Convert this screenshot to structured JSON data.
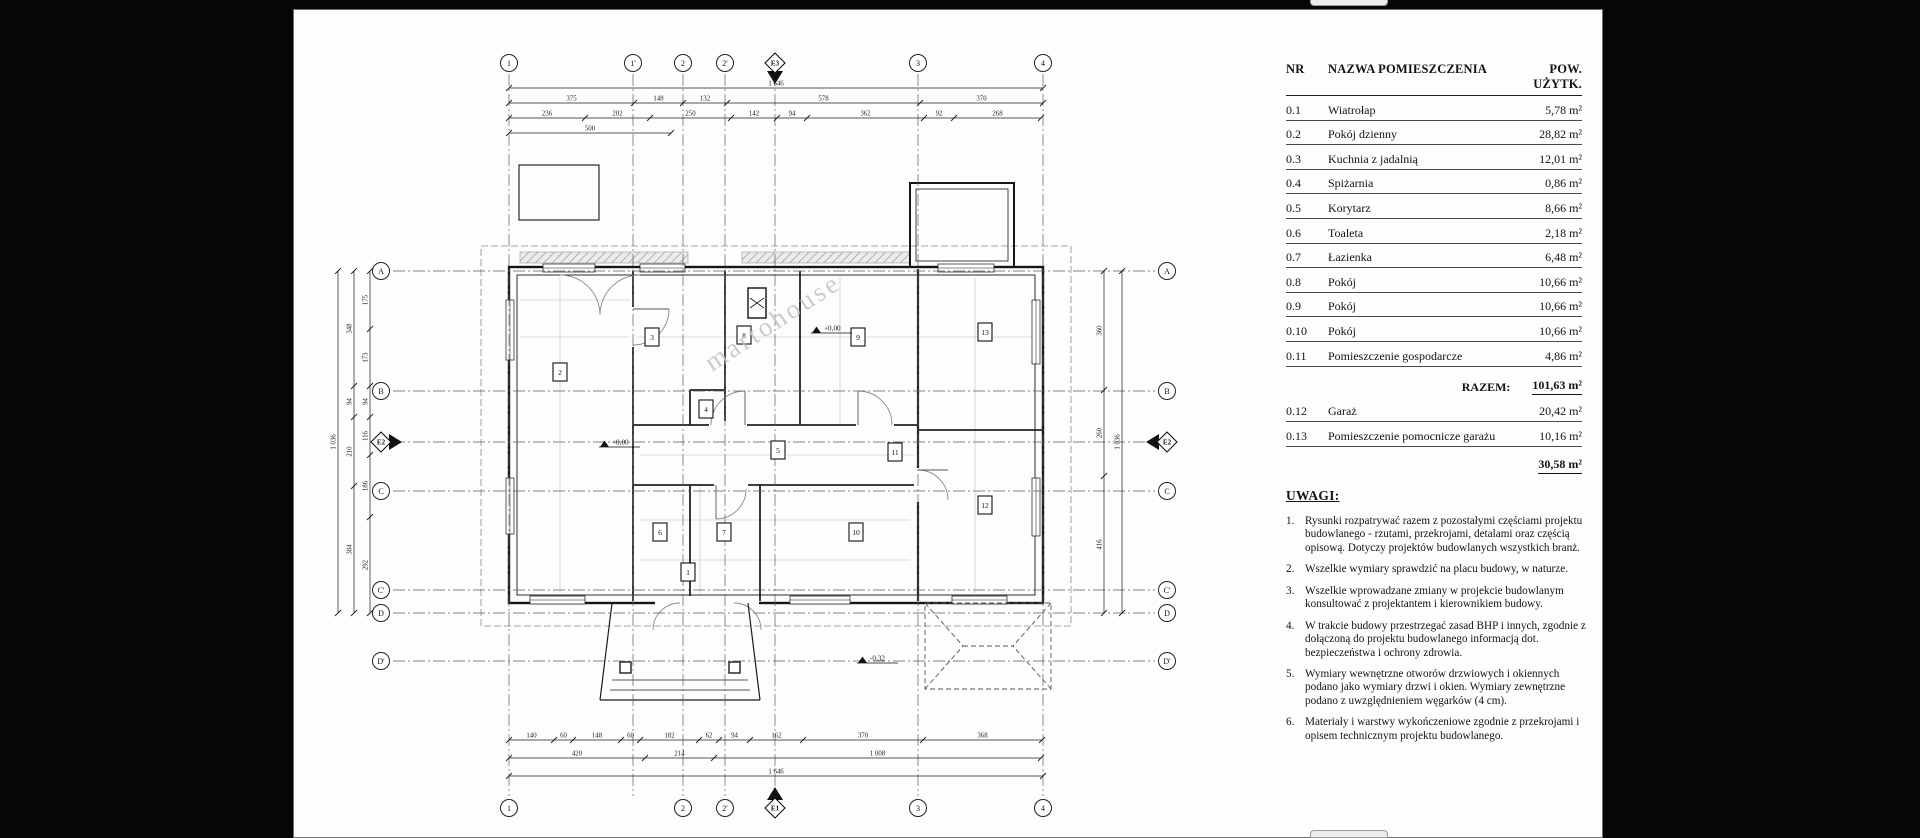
{
  "page": {
    "watermark": "martohouse"
  },
  "table": {
    "headers": {
      "nr": "NR",
      "name": "NAZWA POMIESZCZENIA",
      "area": "POW. UŻYTK."
    },
    "rows": [
      {
        "nr": "0.1",
        "name": "Wiatrołap",
        "area": "5,78 m²"
      },
      {
        "nr": "0.2",
        "name": "Pokój dzienny",
        "area": "28,82 m²"
      },
      {
        "nr": "0.3",
        "name": "Kuchnia z jadalnią",
        "area": "12,01 m²"
      },
      {
        "nr": "0.4",
        "name": "Spiżarnia",
        "area": "0,86 m²"
      },
      {
        "nr": "0.5",
        "name": "Korytarz",
        "area": "8,66 m²"
      },
      {
        "nr": "0.6",
        "name": "Toaleta",
        "area": "2,18 m²"
      },
      {
        "nr": "0.7",
        "name": "Łazienka",
        "area": "6,48 m²"
      },
      {
        "nr": "0.8",
        "name": "Pokój",
        "area": "10,66 m²"
      },
      {
        "nr": "0.9",
        "name": "Pokój",
        "area": "10,66 m²"
      },
      {
        "nr": "0.10",
        "name": "Pokój",
        "area": "10,66 m²"
      },
      {
        "nr": "0.11",
        "name": "Pomieszczenie gospodarcze",
        "area": "4,86 m²"
      }
    ],
    "razem_label": "RAZEM:",
    "razem_value": "101,63 m²",
    "extra_rows": [
      {
        "nr": "0.12",
        "name": "Garaż",
        "area": "20,42 m²"
      },
      {
        "nr": "0.13",
        "name": "Pomieszczenie pomocnicze garażu",
        "area": "10,16 m²"
      }
    ],
    "extra_total": "30,58 m²"
  },
  "notes": {
    "heading": "UWAGI:",
    "items": [
      "Rysunki rozpatrywać razem z pozostałymi częściami projektu budowlanego - rzutami, przekrojami, detalami oraz częścią opisową. Dotyczy projektów budowlanych wszystkich branż.",
      "Wszelkie wymiary sprawdzić na placu budowy, w naturze.",
      "Wszelkie wprowadzane zmiany w projekcie budowlanym konsultować z projektantem i kierownikiem budowy.",
      "W trakcie budowy przestrzegać zasad BHP i innych, zgodnie z dołączoną do projektu budowlanego informacją dot. bezpieczeństwa i ochrony zdrowia.",
      "Wymiary wewnętrzne otworów drzwiowych i okiennych podano jako wymiary drzwi i okien. Wymiary zewnętrzne podano z uwzględnieniem węgarków (4 cm).",
      "Materiały i warstwy wykończeniowe zgodnie z przekrojami i opisem technicznym projektu budowlanego."
    ]
  },
  "plan": {
    "grid_top": [
      "1",
      "1'",
      "2",
      "2'",
      "3",
      "4"
    ],
    "grid_bottom": [
      "1",
      "2",
      "2'",
      "3",
      "4"
    ],
    "grid_left": [
      "A",
      "B",
      "C",
      "C'",
      "D",
      "D'"
    ],
    "grid_right": [
      "A",
      "B",
      "C",
      "C'",
      "D",
      "D'"
    ],
    "sections": {
      "top": "E3",
      "bottom": "E1",
      "left": "E2",
      "right": "E2"
    },
    "rooms": [
      "1",
      "2",
      "3",
      "4",
      "5",
      "6",
      "7",
      "8",
      "9",
      "10",
      "11",
      "12",
      "13"
    ],
    "levels": [
      "+0,00",
      "+0,00",
      "-0,32"
    ],
    "dimensions": {
      "top": [
        [
          "1 646"
        ],
        [
          "375",
          "148",
          "132",
          "578",
          "370"
        ],
        [
          "236",
          "202",
          "250",
          "142",
          "94",
          "362",
          "92",
          "268"
        ],
        [
          "500"
        ]
      ],
      "bottom": [
        [
          "140",
          "60",
          "148",
          "60",
          "182",
          "62",
          "94",
          "162",
          "370",
          "368"
        ],
        [
          "420",
          "214",
          "1 008"
        ],
        [
          "1 646"
        ]
      ],
      "left": [
        [
          "1 036"
        ],
        [
          "348",
          "94",
          "210",
          "384"
        ],
        [
          "175",
          "173",
          "94",
          "116",
          "186",
          "292"
        ]
      ],
      "right": [
        [
          "360",
          "260",
          "416"
        ],
        [
          "1 036"
        ]
      ]
    }
  }
}
